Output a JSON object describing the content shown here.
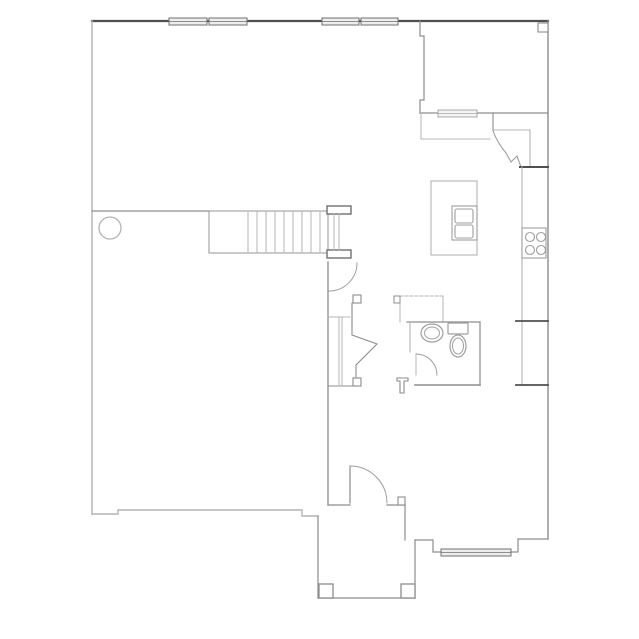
{
  "canvas": {
    "width": 639,
    "height": 639,
    "background": "#ffffff"
  },
  "palette": {
    "dark": "#4f4f4f",
    "wall": "#8d8d8d",
    "mid": "#9e9e9e",
    "light": "#b4b4b4",
    "fixture": "#9f9f9f",
    "window_border": "#6f6f6f",
    "window_fill": "#ededed",
    "window_light_border": "#a8a8a8",
    "window_light_fill": "#f4f4f4",
    "white": "#ffffff"
  },
  "floorplan": {
    "description": "single-story-floor-plan-line-drawing",
    "elements": [
      {
        "n": "top-exterior-wall",
        "t": "line",
        "x1": 92,
        "y1": 21,
        "x2": 548,
        "y2": 21,
        "tone": "dark",
        "sw": 2.2
      },
      {
        "n": "right-exterior-wall",
        "t": "line",
        "x1": 548,
        "y1": 21,
        "x2": 548,
        "y2": 539,
        "tone": "wall",
        "sw": 1.4
      },
      {
        "n": "left-exterior-wall",
        "t": "line",
        "x1": 92,
        "y1": 21,
        "x2": 92,
        "y2": 514,
        "tone": "light",
        "sw": 1.4
      },
      {
        "n": "bottom-exterior-wall",
        "t": "polyline",
        "pts": "92,514 118,514 118,510 302,510 302,516 318,516",
        "tone": "light",
        "sw": 1.4
      },
      {
        "n": "porch-left-wall",
        "t": "line",
        "x1": 318,
        "y1": 516,
        "x2": 318,
        "y2": 598,
        "tone": "wall",
        "sw": 1.2
      },
      {
        "n": "porch-bottom-wall",
        "t": "line",
        "x1": 318,
        "y1": 598,
        "x2": 415,
        "y2": 598,
        "tone": "wall",
        "sw": 1.2
      },
      {
        "n": "porch-right-wall",
        "t": "line",
        "x1": 415,
        "y1": 598,
        "x2": 415,
        "y2": 540,
        "tone": "wall",
        "sw": 1.2
      },
      {
        "n": "entry-right-jog-wall",
        "t": "polyline",
        "pts": "415,540 433,540 433,552 441,552",
        "tone": "wall",
        "sw": 1.2
      },
      {
        "n": "front-wall-right",
        "t": "polyline",
        "pts": "511,552 518,552 518,539 548,539",
        "tone": "wall",
        "sw": 1.2
      },
      {
        "n": "upper-room-left-wall",
        "t": "polyline",
        "pts": "420,21 420,36 424,36 424,100 420,100 420,113",
        "tone": "wall",
        "sw": 1.2
      },
      {
        "n": "upper-room-bottom-wall",
        "t": "line",
        "x1": 420,
        "y1": 113,
        "x2": 548,
        "y2": 113,
        "tone": "wall",
        "sw": 1.2
      },
      {
        "n": "corner-post",
        "t": "rect",
        "x": 538,
        "y": 23,
        "w2": 10,
        "h": 9,
        "tone": "wall",
        "sw": 1.1,
        "f": "white"
      },
      {
        "n": "pantry-left-wall",
        "t": "line",
        "x1": 493,
        "y1": 113,
        "x2": 493,
        "y2": 131,
        "tone": "wall",
        "sw": 1.1
      },
      {
        "n": "pantry-top-wall",
        "t": "line",
        "x1": 493,
        "y1": 130,
        "x2": 530,
        "y2": 130,
        "tone": "light",
        "sw": 1.1
      },
      {
        "n": "pantry-right-wall",
        "t": "line",
        "x1": 530,
        "y1": 130,
        "x2": 530,
        "y2": 167,
        "tone": "light",
        "sw": 1.1
      },
      {
        "n": "pantry-door-leaf",
        "t": "path",
        "d": "M493,131 C496,139 500,146 506,153 L511,162",
        "tone": "mid",
        "sw": 1.1
      },
      {
        "n": "pantry-door-jamb",
        "t": "polyline",
        "pts": "511,162 517,156 521,167",
        "tone": "mid",
        "sw": 1.1
      },
      {
        "n": "kitchen-wall-segment",
        "t": "line",
        "x1": 520,
        "y1": 167,
        "x2": 548,
        "y2": 167,
        "tone": "dark",
        "sw": 2
      },
      {
        "n": "kitchen-counter-edge",
        "t": "line",
        "x1": 522,
        "y1": 167,
        "x2": 522,
        "y2": 385,
        "tone": "light",
        "sw": 1.1
      },
      {
        "n": "refrigerator-top-edge",
        "t": "line",
        "x1": 516,
        "y1": 321,
        "x2": 548,
        "y2": 321,
        "tone": "dark",
        "sw": 1.8
      },
      {
        "n": "refrigerator-bottom-edge",
        "t": "line",
        "x1": 516,
        "y1": 385,
        "x2": 548,
        "y2": 385,
        "tone": "dark",
        "sw": 1.8
      },
      {
        "n": "cooktop",
        "t": "rect",
        "x": 522,
        "y": 228,
        "w2": 24,
        "h": 30,
        "tone": "fixture",
        "sw": 1.1,
        "f": "white"
      },
      {
        "n": "cooktop-burner-1",
        "t": "circle",
        "cx": 530,
        "cy": 237,
        "r": 4.5,
        "tone": "fixture",
        "sw": 1.1
      },
      {
        "n": "cooktop-burner-2",
        "t": "circle",
        "cx": 541,
        "cy": 237,
        "r": 4.5,
        "tone": "fixture",
        "sw": 1.1
      },
      {
        "n": "cooktop-burner-3",
        "t": "circle",
        "cx": 530,
        "cy": 250,
        "r": 4.5,
        "tone": "fixture",
        "sw": 1.1
      },
      {
        "n": "cooktop-burner-4",
        "t": "circle",
        "cx": 541,
        "cy": 250,
        "r": 4.5,
        "tone": "fixture",
        "sw": 1.1
      },
      {
        "n": "kitchen-island",
        "t": "rect",
        "x": 431,
        "y": 181,
        "w2": 46,
        "h": 74,
        "tone": "light",
        "sw": 1.1
      },
      {
        "n": "island-sink",
        "t": "rect",
        "x": 452,
        "y": 206,
        "w2": 25,
        "h": 34,
        "tone": "fixture",
        "sw": 1.1
      },
      {
        "n": "island-sink-basin-upper",
        "t": "rect",
        "x": 455,
        "y": 209,
        "w2": 18,
        "h": 14,
        "rx": 2,
        "tone": "fixture",
        "sw": 1.1
      },
      {
        "n": "island-sink-basin-lower",
        "t": "rect",
        "x": 455,
        "y": 225,
        "w2": 18,
        "h": 13,
        "rx": 2,
        "tone": "fixture",
        "sw": 1.1
      },
      {
        "n": "nook-edge-vertical",
        "t": "line",
        "x1": 421,
        "y1": 113,
        "x2": 421,
        "y2": 139,
        "tone": "light",
        "sw": 1
      },
      {
        "n": "nook-edge-horizontal",
        "t": "line",
        "x1": 421,
        "y1": 139,
        "x2": 490,
        "y2": 139,
        "tone": "light",
        "sw": 1
      },
      {
        "n": "stair-side-wall",
        "t": "line",
        "x1": 92,
        "y1": 211,
        "x2": 209,
        "y2": 211,
        "tone": "wall",
        "sw": 1.2
      },
      {
        "n": "staircase-outline",
        "t": "rect",
        "x": 209,
        "y": 211,
        "w2": 119,
        "h": 42,
        "tone": "mid",
        "sw": 1.1
      },
      {
        "n": "stair-tread-1",
        "t": "line",
        "x1": 248,
        "y1": 211,
        "x2": 248,
        "y2": 253,
        "tone": "light",
        "sw": 1
      },
      {
        "n": "stair-tread-2",
        "t": "line",
        "x1": 257,
        "y1": 211,
        "x2": 257,
        "y2": 253,
        "tone": "light",
        "sw": 1
      },
      {
        "n": "stair-tread-3",
        "t": "line",
        "x1": 266,
        "y1": 211,
        "x2": 266,
        "y2": 253,
        "tone": "light",
        "sw": 1
      },
      {
        "n": "stair-tread-4",
        "t": "line",
        "x1": 275,
        "y1": 211,
        "x2": 275,
        "y2": 253,
        "tone": "light",
        "sw": 1
      },
      {
        "n": "stair-tread-5",
        "t": "line",
        "x1": 284,
        "y1": 211,
        "x2": 284,
        "y2": 253,
        "tone": "light",
        "sw": 1
      },
      {
        "n": "stair-tread-6",
        "t": "line",
        "x1": 293,
        "y1": 211,
        "x2": 293,
        "y2": 253,
        "tone": "light",
        "sw": 1
      },
      {
        "n": "stair-tread-7",
        "t": "line",
        "x1": 302,
        "y1": 211,
        "x2": 302,
        "y2": 253,
        "tone": "light",
        "sw": 1
      },
      {
        "n": "stair-tread-8",
        "t": "line",
        "x1": 311,
        "y1": 211,
        "x2": 311,
        "y2": 253,
        "tone": "light",
        "sw": 1
      },
      {
        "n": "stair-tread-9",
        "t": "line",
        "x1": 320,
        "y1": 211,
        "x2": 320,
        "y2": 253,
        "tone": "light",
        "sw": 1
      },
      {
        "n": "stair-rail-post-top",
        "t": "rect",
        "x": 327,
        "y": 206,
        "w2": 24,
        "h": 8,
        "tone": "winb",
        "sw": 1.4,
        "f": "white"
      },
      {
        "n": "stair-rail-post-bottom",
        "t": "rect",
        "x": 327,
        "y": 250,
        "w2": 24,
        "h": 8,
        "tone": "winb",
        "sw": 1.4,
        "f": "white"
      },
      {
        "n": "stair-rail-line-a",
        "t": "line",
        "x1": 334,
        "y1": 214,
        "x2": 334,
        "y2": 250,
        "tone": "light",
        "sw": 1
      },
      {
        "n": "stair-rail-line-b",
        "t": "line",
        "x1": 339,
        "y1": 214,
        "x2": 339,
        "y2": 250,
        "tone": "light",
        "sw": 1
      },
      {
        "n": "hall-wall",
        "t": "line",
        "x1": 328,
        "y1": 262,
        "x2": 328,
        "y2": 505,
        "tone": "wall",
        "sw": 1.3
      },
      {
        "n": "understair-door-arc",
        "t": "path",
        "d": "M357,263 A28 28 0 0 1 329,291",
        "tone": "mid",
        "sw": 1
      },
      {
        "n": "closet-shelf-top",
        "t": "line",
        "x1": 328,
        "y1": 317,
        "x2": 350,
        "y2": 317,
        "tone": "light",
        "sw": 1
      },
      {
        "n": "closet-bottom-wall",
        "t": "line",
        "x1": 328,
        "y1": 386,
        "x2": 356,
        "y2": 386,
        "tone": "wall",
        "sw": 1.1
      },
      {
        "n": "closet-rod-a",
        "t": "line",
        "x1": 339,
        "y1": 317,
        "x2": 339,
        "y2": 386,
        "tone": "light",
        "sw": 1
      },
      {
        "n": "closet-rod-b",
        "t": "line",
        "x1": 342,
        "y1": 317,
        "x2": 342,
        "y2": 386,
        "tone": "light",
        "sw": 1
      },
      {
        "n": "closet-angled-wall",
        "t": "polyline",
        "pts": "352,303 352,335 377,344 356,365 356,378",
        "tone": "wall",
        "sw": 1.1
      },
      {
        "n": "closet-door-jamb-top",
        "t": "rect",
        "x": 353,
        "y": 295,
        "w2": 8,
        "h": 8,
        "tone": "wall",
        "sw": 1.1,
        "f": "white"
      },
      {
        "n": "closet-door-jamb-bottom",
        "t": "rect",
        "x": 353,
        "y": 378,
        "w2": 8,
        "h": 8,
        "tone": "wall",
        "sw": 1.1,
        "f": "white"
      },
      {
        "n": "utility-top-line",
        "t": "line",
        "x1": 395,
        "y1": 296,
        "x2": 443,
        "y2": 296,
        "tone": "light",
        "sw": 1,
        "dash": "3,2"
      },
      {
        "n": "utility-left-line",
        "t": "line",
        "x1": 400,
        "y1": 296,
        "x2": 400,
        "y2": 322,
        "tone": "light",
        "sw": 1
      },
      {
        "n": "utility-right-line",
        "t": "line",
        "x1": 443,
        "y1": 296,
        "x2": 443,
        "y2": 322,
        "tone": "light",
        "sw": 1
      },
      {
        "n": "utility-door-jamb",
        "t": "rect",
        "x": 394,
        "y": 296,
        "w2": 6,
        "h": 7,
        "tone": "wall",
        "sw": 1,
        "f": "white"
      },
      {
        "n": "bath-top-wall",
        "t": "line",
        "x1": 407,
        "y1": 322,
        "x2": 480,
        "y2": 322,
        "tone": "wall",
        "sw": 1.2
      },
      {
        "n": "bath-left-wall",
        "t": "line",
        "x1": 410,
        "y1": 322,
        "x2": 410,
        "y2": 352,
        "tone": "light",
        "sw": 1.1
      },
      {
        "n": "bath-right-wall",
        "t": "line",
        "x1": 480,
        "y1": 322,
        "x2": 480,
        "y2": 385,
        "tone": "wall",
        "sw": 1.2
      },
      {
        "n": "bath-bottom-wall",
        "t": "line",
        "x1": 415,
        "y1": 385,
        "x2": 480,
        "y2": 385,
        "tone": "wall",
        "sw": 1.6
      },
      {
        "n": "bath-door-leaf",
        "t": "line",
        "x1": 416,
        "y1": 354,
        "x2": 416,
        "y2": 375,
        "tone": "light",
        "sw": 1
      },
      {
        "n": "bath-door-arc",
        "t": "path",
        "d": "M416,354 A21 21 0 0 1 437,375",
        "tone": "mid",
        "sw": 1
      },
      {
        "n": "toilet-tank",
        "t": "rect",
        "x": 448,
        "y": 323,
        "w2": 20,
        "h": 11,
        "rx": 1,
        "tone": "fixture",
        "sw": 1.2
      },
      {
        "n": "toilet-bowl-outer",
        "t": "ellipse",
        "cx": 458,
        "cy": 346,
        "rx": 8,
        "ry": 11,
        "tone": "fixture",
        "sw": 1.2
      },
      {
        "n": "toilet-bowl-inner",
        "t": "ellipse",
        "cx": 458,
        "cy": 346,
        "rx": 5.5,
        "ry": 8,
        "tone": "fixture",
        "sw": 1
      },
      {
        "n": "vanity-sink-outer",
        "t": "ellipse",
        "cx": 432,
        "cy": 333,
        "rx": 11,
        "ry": 9,
        "tone": "fixture",
        "sw": 1.2
      },
      {
        "n": "vanity-sink-inner",
        "t": "ellipse",
        "cx": 432,
        "cy": 333,
        "rx": 7.5,
        "ry": 6,
        "tone": "fixture",
        "sw": 1
      },
      {
        "n": "hall-wall-stub",
        "t": "polyline",
        "pts": "397,378 408,378 408,381 404,381 404,393 400,393 400,381 397,381 397,378",
        "tone": "wall",
        "sw": 1.1
      },
      {
        "n": "entry-wall-left",
        "t": "line",
        "x1": 328,
        "y1": 505,
        "x2": 350,
        "y2": 505,
        "tone": "wall",
        "sw": 1.3
      },
      {
        "n": "entry-wall-right",
        "t": "line",
        "x1": 387,
        "y1": 505,
        "x2": 405,
        "y2": 505,
        "tone": "wall",
        "sw": 1.3
      },
      {
        "n": "entry-door-jamb",
        "t": "rect",
        "x": 398,
        "y": 497,
        "w2": 7,
        "h": 8,
        "tone": "wall",
        "sw": 1.1,
        "f": "white"
      },
      {
        "n": "entry-side-wall",
        "t": "line",
        "x1": 405,
        "y1": 505,
        "x2": 405,
        "y2": 540,
        "tone": "wall",
        "sw": 1.2
      },
      {
        "n": "front-door-leaf",
        "t": "line",
        "x1": 350,
        "y1": 466,
        "x2": 350,
        "y2": 503,
        "tone": "wall",
        "sw": 1.2
      },
      {
        "n": "front-door-arc",
        "t": "path",
        "d": "M350,466 A37 37 0 0 1 387,503",
        "tone": "mid",
        "sw": 1
      },
      {
        "n": "porch-column-left",
        "t": "rect",
        "x": 319,
        "y": 584,
        "w2": 14,
        "h": 14,
        "tone": "wall",
        "sw": 1.3,
        "f": "white"
      },
      {
        "n": "porch-column-right",
        "t": "rect",
        "x": 401,
        "y": 584,
        "w2": 14,
        "h": 14,
        "tone": "wall",
        "sw": 1.3,
        "f": "white"
      },
      {
        "n": "support-column",
        "t": "circle",
        "cx": 110,
        "cy": 228,
        "r": 11,
        "tone": "light",
        "sw": 1.3
      },
      {
        "n": "window-top-1",
        "t": "window",
        "x": 169,
        "y": 18,
        "w2": 38,
        "h": 7
      },
      {
        "n": "window-top-2",
        "t": "window",
        "x": 209,
        "y": 18,
        "w2": 38,
        "h": 7
      },
      {
        "n": "window-top-3",
        "t": "window",
        "x": 322,
        "y": 18,
        "w2": 37,
        "h": 7
      },
      {
        "n": "window-top-4",
        "t": "window",
        "x": 361,
        "y": 18,
        "w2": 37,
        "h": 7
      },
      {
        "n": "window-upper-room",
        "t": "window",
        "x": 438,
        "y": 110,
        "w2": 39,
        "h": 7,
        "lightwin": true
      },
      {
        "n": "window-front",
        "t": "window",
        "x": 441,
        "y": 549,
        "w2": 70,
        "h": 7
      }
    ]
  }
}
